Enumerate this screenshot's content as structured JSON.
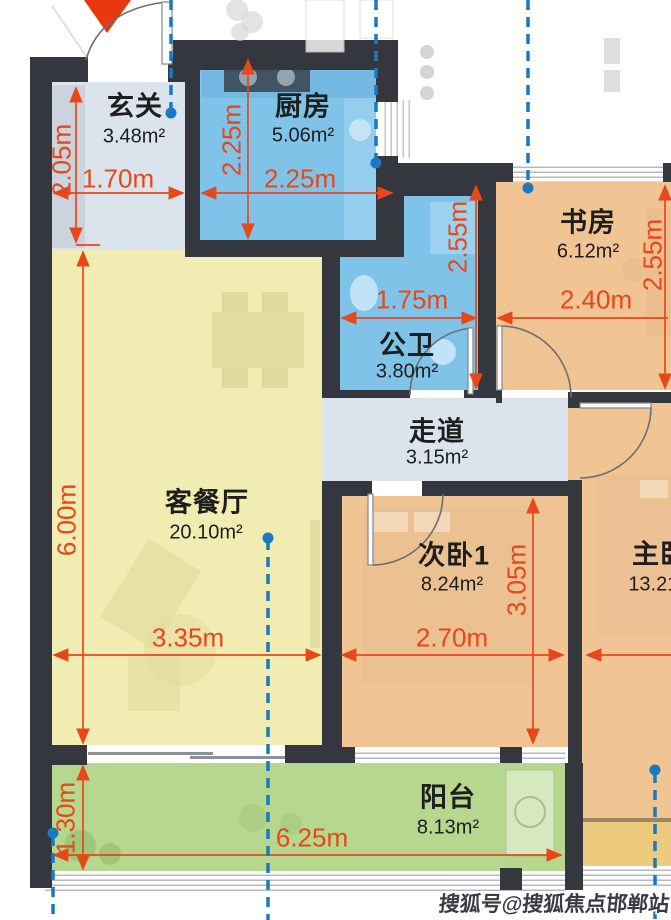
{
  "rooms": {
    "xuanguan": {
      "label": "玄关",
      "area": "3.48m²"
    },
    "chufang": {
      "label": "厨房",
      "area": "5.06m²"
    },
    "shufang": {
      "label": "书房",
      "area": "6.12m²"
    },
    "gongwei": {
      "label": "公卫",
      "area": "3.80m²"
    },
    "zoudao": {
      "label": "走道",
      "area": "3.15m²"
    },
    "kecanting": {
      "label": "客餐厅",
      "area": "20.10m²"
    },
    "ciwo1": {
      "label": "次卧1",
      "area": "8.24m²"
    },
    "zhuwo": {
      "label": "主卧",
      "area": "13.21m²"
    },
    "yangtai": {
      "label": "阳台",
      "area": "8.13m²"
    }
  },
  "dimensions": {
    "hall_height": "2.05m",
    "hall_width": "1.70m",
    "kitchen_height": "2.25m",
    "kitchen_width": "2.25m",
    "bath_height": "2.55m",
    "bath_width": "1.75m",
    "study_width": "2.40m",
    "study_height": "2.55m",
    "living_height": "6.00m",
    "living_width": "3.35m",
    "bedroom1_width": "2.70m",
    "bedroom1_height": "3.05m",
    "balcony_height": "1.30m",
    "balcony_width": "6.25m"
  },
  "watermark": "搜狐号@搜狐焦点邯郸站",
  "colors": {
    "wall": "#34383E",
    "wet-blue": "#7FC3E9",
    "hall-gray": "#DBE3EC",
    "living-yellow": "#F0ECB2",
    "bedroom-tan": "#F0C493",
    "balcony-green": "#B6D88E",
    "bay-yellow": "#EECA7E",
    "dim-red": "#E8471A",
    "guide-blue": "#1A79C0",
    "entry-red": "#E8380D"
  }
}
